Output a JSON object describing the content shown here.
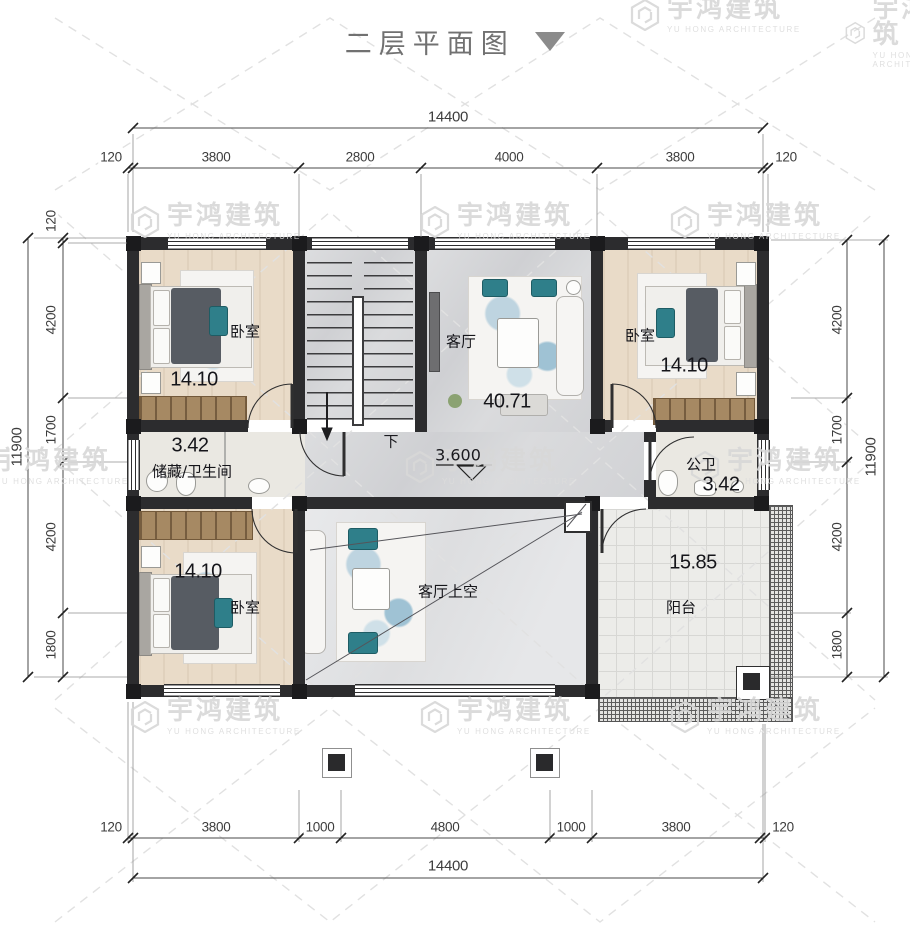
{
  "title": {
    "text": "二层平面图"
  },
  "watermark": {
    "name": "宇鸿建筑",
    "subtitle": "YU HONG ARCHITECTURE"
  },
  "dimensions": {
    "top": {
      "overall": "14400",
      "segments": [
        "120",
        "3800",
        "2800",
        "4000",
        "3800",
        "120"
      ]
    },
    "bottom": {
      "overall": "14400",
      "segments": [
        "120",
        "3800",
        "1000",
        "4800",
        "1000",
        "3800",
        "120"
      ]
    },
    "left": {
      "overall": "11900",
      "segments": [
        "120",
        "4200",
        "1700",
        "4200",
        "1800"
      ]
    },
    "right": {
      "overall": "11900",
      "segments": [
        "4200",
        "1700",
        "4200",
        "1800"
      ]
    }
  },
  "rooms": {
    "bedroom_top_left": {
      "name": "卧室",
      "area": "14.10"
    },
    "living_room": {
      "name": "客厅",
      "area": "40.71"
    },
    "bedroom_top_right": {
      "name": "卧室",
      "area": "14.10"
    },
    "storage_bathroom": {
      "name": "储藏/卫生间",
      "area": "3.42"
    },
    "public_bathroom": {
      "name": "公卫",
      "area": "3.42"
    },
    "bedroom_bottom_left": {
      "name": "卧室",
      "area": "14.10"
    },
    "living_void": {
      "name": "客厅上空"
    },
    "balcony": {
      "name": "阳台",
      "area": "15.85"
    }
  },
  "annotations": {
    "stair_direction": "下",
    "floor_level": "3.600"
  },
  "colors": {
    "wall": "#2c2c2e",
    "wood_floor": "#e9dbc8",
    "marble_floor": "#d4d5d8",
    "accent_teal": "#2f7f8a",
    "wardrobe": "#a68963",
    "watermark": "#d8d8d8"
  }
}
